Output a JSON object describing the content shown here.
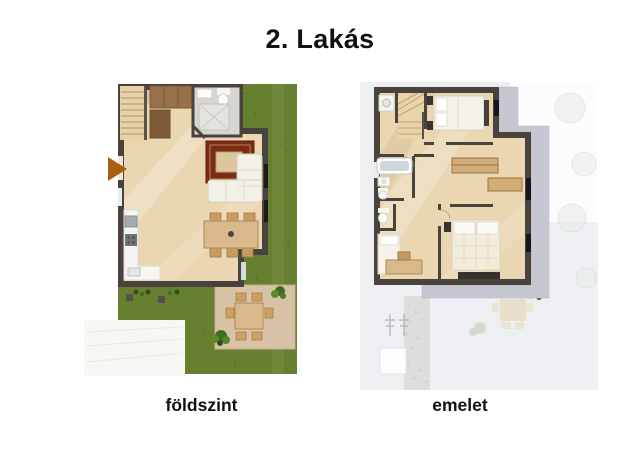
{
  "title": "2. Lakás",
  "plans": {
    "ground": {
      "label": "földszint"
    },
    "upper": {
      "label": "emelet"
    }
  },
  "icons": {
    "entrance_arrow": "▶"
  },
  "colors": {
    "title_text": "#111111",
    "wall": "#4a423c",
    "wood_floor": "#ead6b0",
    "grass": "#66802f",
    "tile": "#d7d6d0",
    "rug": "#7b2b16",
    "sofa": "#f3f0e7",
    "patio_stone": "#d8c2a5",
    "furniture_wood": "#d9b98b",
    "bed_linen": "#f5f2ea",
    "roof_band": "#c6c7d1",
    "upper_ground_bg": "#edeff2",
    "entrance_arrow": "#a9600f"
  }
}
